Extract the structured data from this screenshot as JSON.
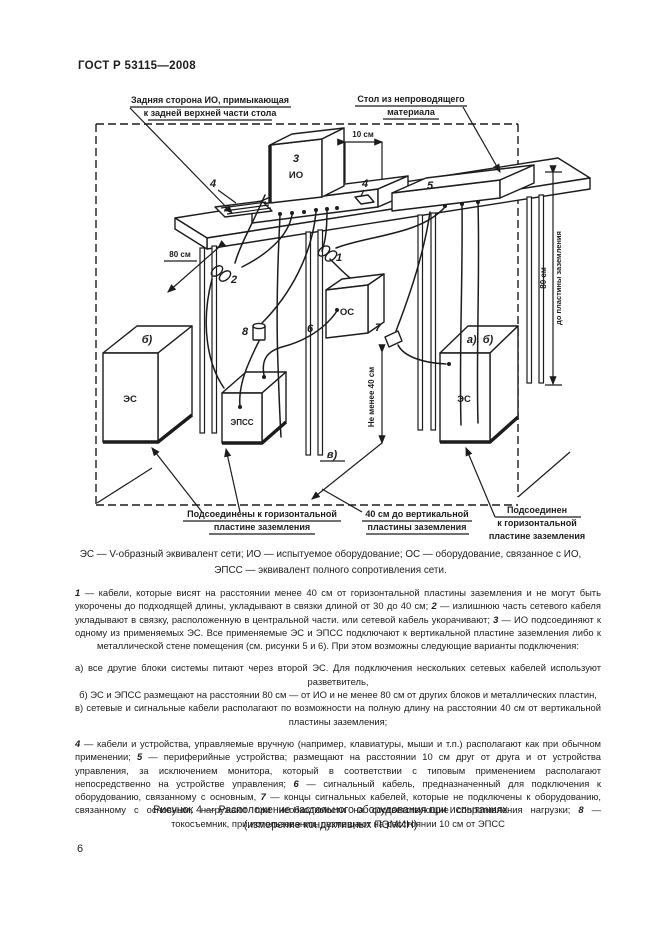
{
  "header": {
    "doc_number": "ГОСТ Р 53115—2008"
  },
  "fig": {
    "callout_back": [
      "Задняя сторона ИО, примыкающая",
      "к задней верхней части стола"
    ],
    "callout_table": [
      "Стол из непроводящего",
      "материала"
    ],
    "dim10": "10 см",
    "dim80_left": "80 см",
    "dim80_right": "80 см",
    "dim_to_plate": "до пластины заземления",
    "dim_not_less_40": "Не менее 40 см",
    "n1": "1",
    "n2": "2",
    "n3": "3",
    "n4a": "4",
    "n4b": "4",
    "n5": "5",
    "n6": "6",
    "n7": "7",
    "n8": "8",
    "io": "ИО",
    "os": "ОС",
    "es_left": "ЭС",
    "es_right": "ЭС",
    "epss": "ЭПСС",
    "mark_b": "б)",
    "mark_ab": "а), б)",
    "mark_v": "в)",
    "ground_left": [
      "Подсоединены к горизонтальной",
      "пластине заземления"
    ],
    "ground_mid": [
      "40 см до вертикальной",
      "пластины заземления"
    ],
    "ground_right": [
      "Подсоединен",
      "к горизонтальной",
      "пластине заземления"
    ]
  },
  "legend": {
    "line1": "ЭС — V-образный эквивалент сети; ИО — испытуемое оборудование; ОС — оборудование, связанное с ИО,",
    "line2": "ЭПСС — эквивалент полного сопротивления сети."
  },
  "notes": {
    "p1": [
      {
        "t": "1",
        "i": true
      },
      {
        "t": " — кабели, которые висят на расстоянии менее 40 см от горизонтальной пластины заземления и не могут быть укорочены до подходящей длины, укладывают в связки длиной от 30 до 40 см; ",
        "i": false
      },
      {
        "t": "2",
        "i": true
      },
      {
        "t": " — излишнюю часть сетевого кабеля укладывают в связку, расположенную в центральной части. или сетевой кабель укорачивают; ",
        "i": false
      },
      {
        "t": "3",
        "i": true
      },
      {
        "t": " — ИО подсоединяют к одному из применяемых ЭС. Все применяемые ЭС и ЭПСС подключают к вертикальной пластине заземления либо к металлической стене помещения (см. рисунки 5 и 6). При этом возможны следующие варианты подключения:",
        "i": false
      }
    ],
    "a": "а)  все другие блоки системы питают через второй ЭС. Для подключения нескольких сетевых кабелей используют разветвитель,",
    "b": "б)  ЭС и ЭПСС размещают на расстоянии 80 см  —  от ИО и не менее 80 см от других блоков и металлических пластин,",
    "v": "в)  сетевые и сигнальные кабели располагают по возможности на полную длину на расстоянии 40 см от вертикальной пластины заземления;",
    "p48": [
      {
        "t": "4",
        "i": true
      },
      {
        "t": " — кабели и устройства, управляемые вручную (например, клавиатуры, мыши и т.п.) располагают как при обычном применении; ",
        "i": false
      },
      {
        "t": "5",
        "i": true
      },
      {
        "t": " — периферийные устройства; размещают на расстоянии 10 см друг от друга и от устройства управления, за исключением монитора, который в соответствии с типовым применением располагают непосредственно на устройстве управления; ",
        "i": false
      },
      {
        "t": "6",
        "i": true
      },
      {
        "t": " — сигнальный кабель, предназначенный для подключения к оборудованию, связанному с основным, ",
        "i": false
      },
      {
        "t": "7",
        "i": true
      },
      {
        "t": " — концы сигнальных кабелей, которые не подключены к оборудованию, связанному с основным, нагружают при необходимости на соответствующие сопротивления нагрузки; ",
        "i": false
      },
      {
        "t": "8",
        "i": true
      },
      {
        "t": " — токосъемник, при использовании, размещают на расстоянии 10 см от ЭПСС",
        "i": false
      }
    ]
  },
  "caption": {
    "line1": "Рисунок 4 — Расположение настольного оборудования при испытаниях",
    "line2": "(измерение кондуктивных ПЭМИН)"
  },
  "page_number": "6"
}
